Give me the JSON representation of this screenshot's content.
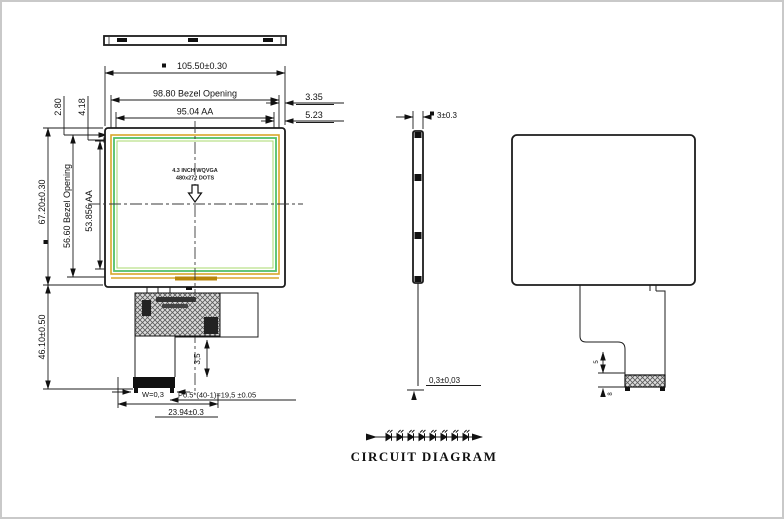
{
  "drawing": {
    "views": {
      "front": {
        "center_line1": "4.3 INCH WQVGA",
        "center_line2": "480x272 DOTS"
      },
      "side": {
        "thickness": "3±0.3",
        "fpc_thickness": "0,3±0,03"
      },
      "back": {
        "fold_height": "5",
        "connector_height": "8"
      },
      "circuit": {
        "title": "CIRCUIT DIAGRAM",
        "led_count": 8
      }
    },
    "dimensions": {
      "overall_width": "105.50±0.30",
      "bezel_width": "98.80 Bezel Opening",
      "aa_width": "95.04 AA",
      "right_offset_bezel": "3.35",
      "right_offset_aa": "5.23",
      "top_offset_bezel": "2.80",
      "top_offset_aa": "4.18",
      "overall_height": "67.20±0.30",
      "bezel_height": "56.60 Bezel Opening",
      "aa_height": "53.856 AA",
      "module_height_with_fpc": "46.10±0.50",
      "fpc_fold": "3,5",
      "tab_width": "W=0,3",
      "pin_pitch": "P0.5*(40-1)=19,5 ±0.05",
      "connector_width": "23.94±0.3"
    },
    "colors": {
      "line": "#1c1c1c",
      "bezel_outline": "#d9a62a",
      "aa_outline": "#52c06a",
      "label_bar": "#b8860b"
    }
  }
}
